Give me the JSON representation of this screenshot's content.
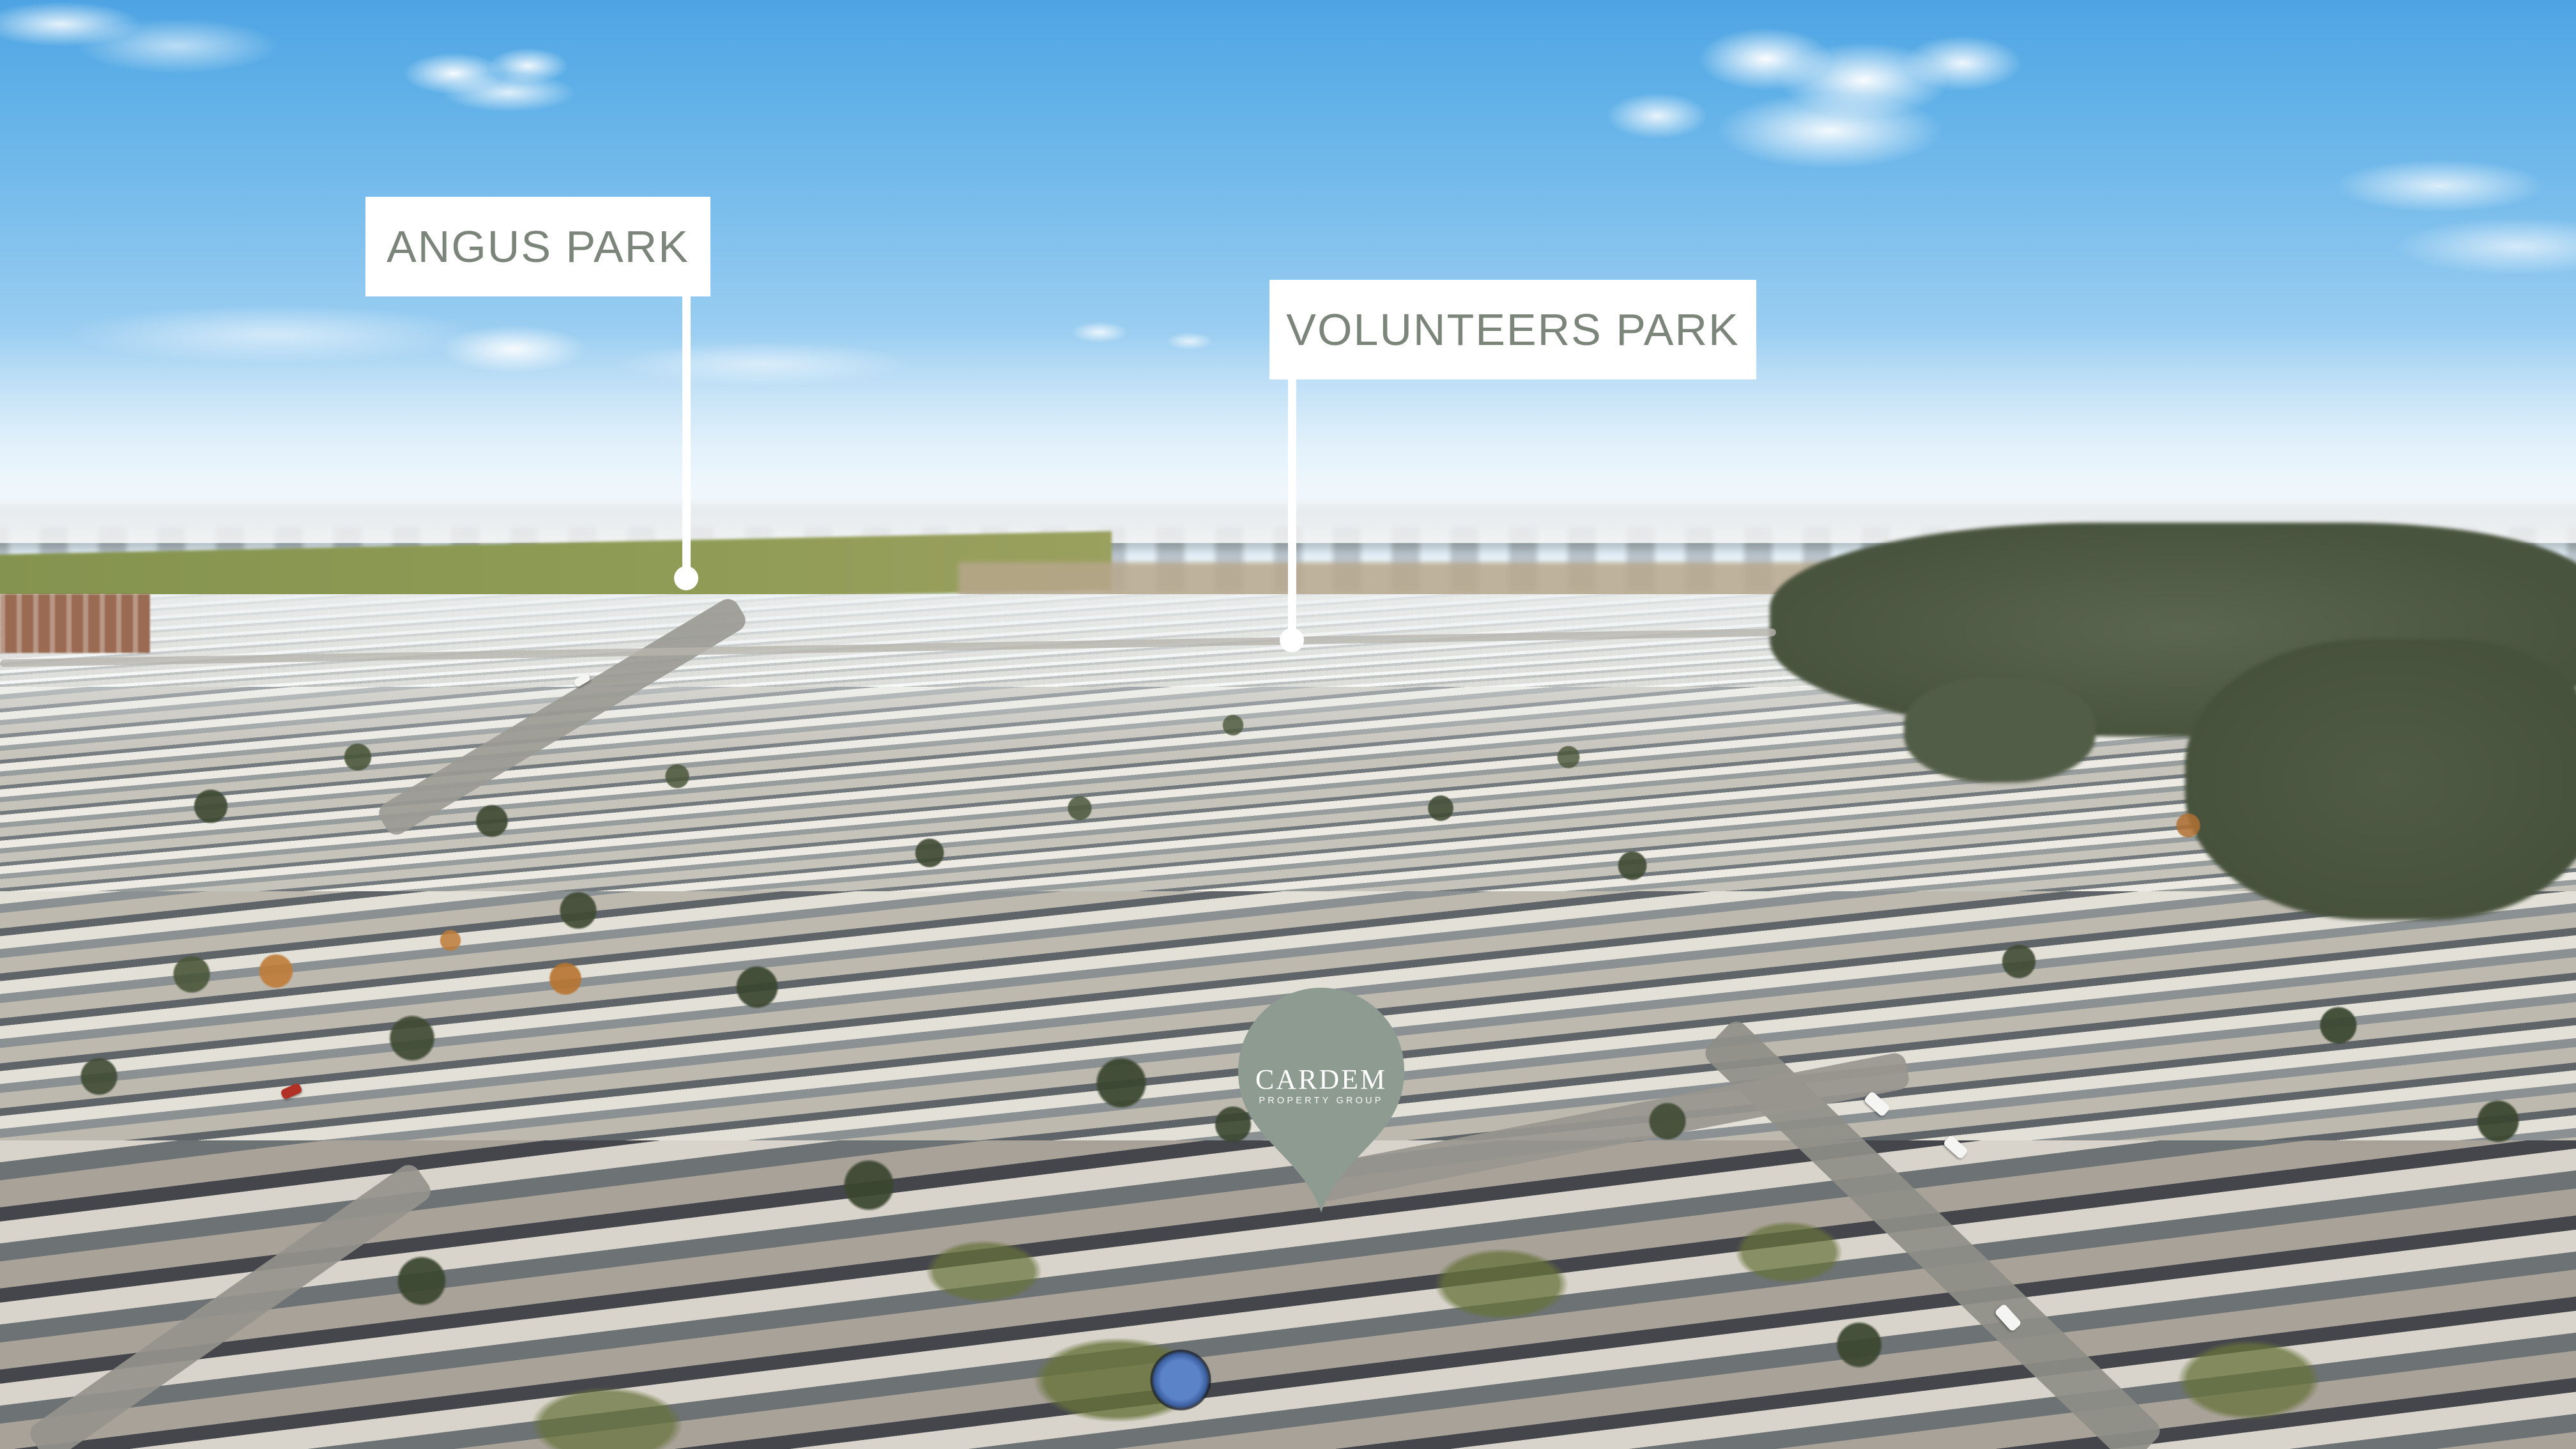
{
  "image": {
    "kind": "aerial-drone-photograph",
    "description": "Aerial view over a new suburban housing estate with green fields and bushland on the horizon under a blue sky with scattered clouds"
  },
  "annotations": {
    "park_labels": [
      {
        "id": "angus-park",
        "text": "ANGUS PARK"
      },
      {
        "id": "volunteers-park",
        "text": "VOLUNTEERS PARK"
      }
    ],
    "brand_pin": {
      "name": "CARDEM",
      "tagline": "PROPERTY GROUP",
      "icon": "map-pin"
    }
  },
  "colors": {
    "label_background": "#ffffff",
    "label_text": "#7c857a",
    "connector_line": "#ffffff",
    "marker_dot": "#ffffff",
    "pin_fill": "#8d9b91",
    "pin_text": "#ffffff",
    "sky_top": "#4ea4e3",
    "sky_horizon": "#e9f3fa",
    "field_green": "#84934f",
    "treeline_green": "#4e5747",
    "roof_gray": "#6f6a63",
    "road_gray": "#98968f"
  }
}
